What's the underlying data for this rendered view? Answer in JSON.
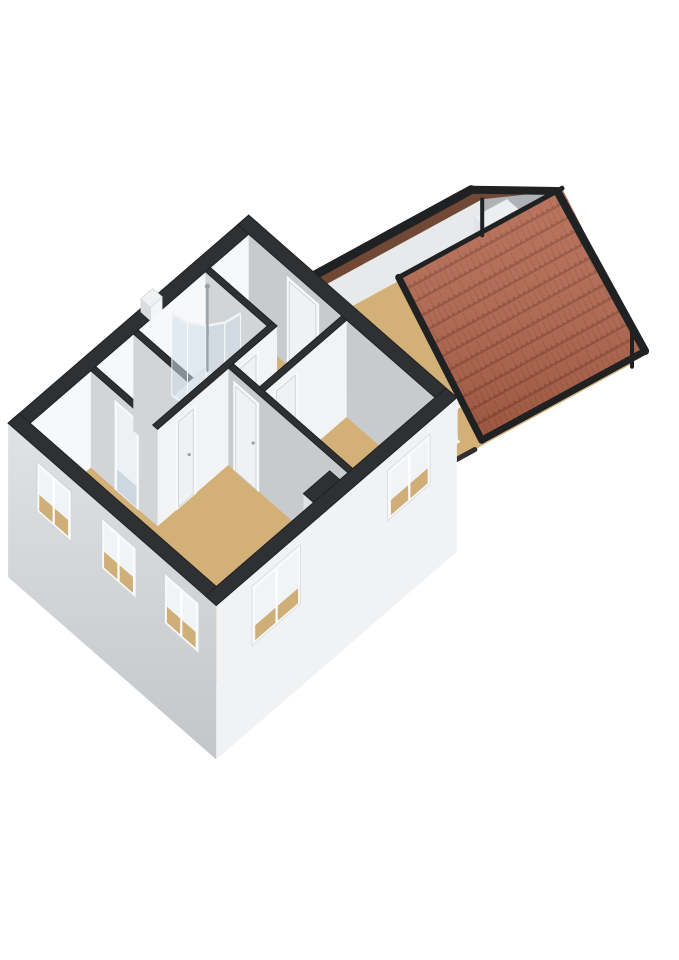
{
  "scene": {
    "kind": "3d-floorplan-render",
    "view": "isometric-overview",
    "floor_shown": "upper-floor-with-attic-extension"
  },
  "colors": {
    "bg": "#ffffff",
    "cap": "#2e3032",
    "cap_stroke": "#1f2123",
    "wall_inner_nw": "#f7f8f9",
    "wall_se_face": "#f2f3f5",
    "wall_gray": "#c7cbce",
    "wall_gray_light": "#d2d5d8",
    "ext_sw_top": "#e0e2e4",
    "ext_sw_bottom": "#c3c6c9",
    "ext_se": "#f1f2f3",
    "floor_tan": "#d3b078",
    "floor_tan_dark": "#c2a06a",
    "floor_bath": "#ccd7e2",
    "roof_tile": "#b2654c",
    "roof_tile_dark": "#8c4836",
    "roof_under": "#714836",
    "roof_under_dark": "#5e3a2d",
    "attic_gable": "#aeb2b6",
    "attic_knee": "#e7e9eb",
    "attic_partition": "#9ea2a6",
    "closet_sw": "#e2e4e6",
    "closet_se": "#f3f4f6",
    "frame": "#f8f9fa",
    "glass": "#f1f4f6",
    "glass_interior_lower": "#cfae77",
    "door": "#f0f1f3",
    "railing": "#f5f6f8",
    "chrome": "#99a0a6",
    "shower_glass": "rgba(208,222,233,0.55)",
    "stair_void": "#43382f",
    "lower_floor": "#bf9e6b"
  },
  "building": {
    "main_house": {
      "rooms": [
        {
          "name": "bedroom-1",
          "floor_finish": "wood-tan",
          "features": [
            "window-sw-1",
            "window-sw-2",
            "window-sw-3",
            "window-se-large",
            "chimney-breast",
            "door-to-hall",
            "closet-doorway"
          ]
        },
        {
          "name": "bedroom-2",
          "floor_finish": "wood-tan",
          "features": [
            "window-se",
            "door-to-hall"
          ]
        },
        {
          "name": "bathroom",
          "floor_finish": "tile-blue-gray",
          "features": [
            "corner-shower",
            "door-to-hall"
          ]
        },
        {
          "name": "toilet-room",
          "floor_finish": "tile-blue-gray",
          "features": [
            "door-to-hall",
            "open-doorway"
          ]
        },
        {
          "name": "landing-hall",
          "floor_finish": "wood-tan",
          "features": [
            "door-to-attic-room"
          ]
        }
      ],
      "exterior": {
        "sw_wall_windows": 3,
        "se_wall_windows": 2,
        "wall_top_trim": "black-cut-cap",
        "roof_vent": true
      }
    },
    "attic_extension": {
      "rooms": [
        {
          "name": "attic-room",
          "floor_finish": "wood-tan",
          "features": [
            "gable-window",
            "built-in-closet",
            "stair-opening",
            "white-railing",
            "knee-walls"
          ]
        }
      ],
      "roof": {
        "se_slope": "terracotta-tiles",
        "nw_slope_underside": "dark-brown",
        "edge_trim": "black",
        "shape": "gable"
      }
    }
  }
}
